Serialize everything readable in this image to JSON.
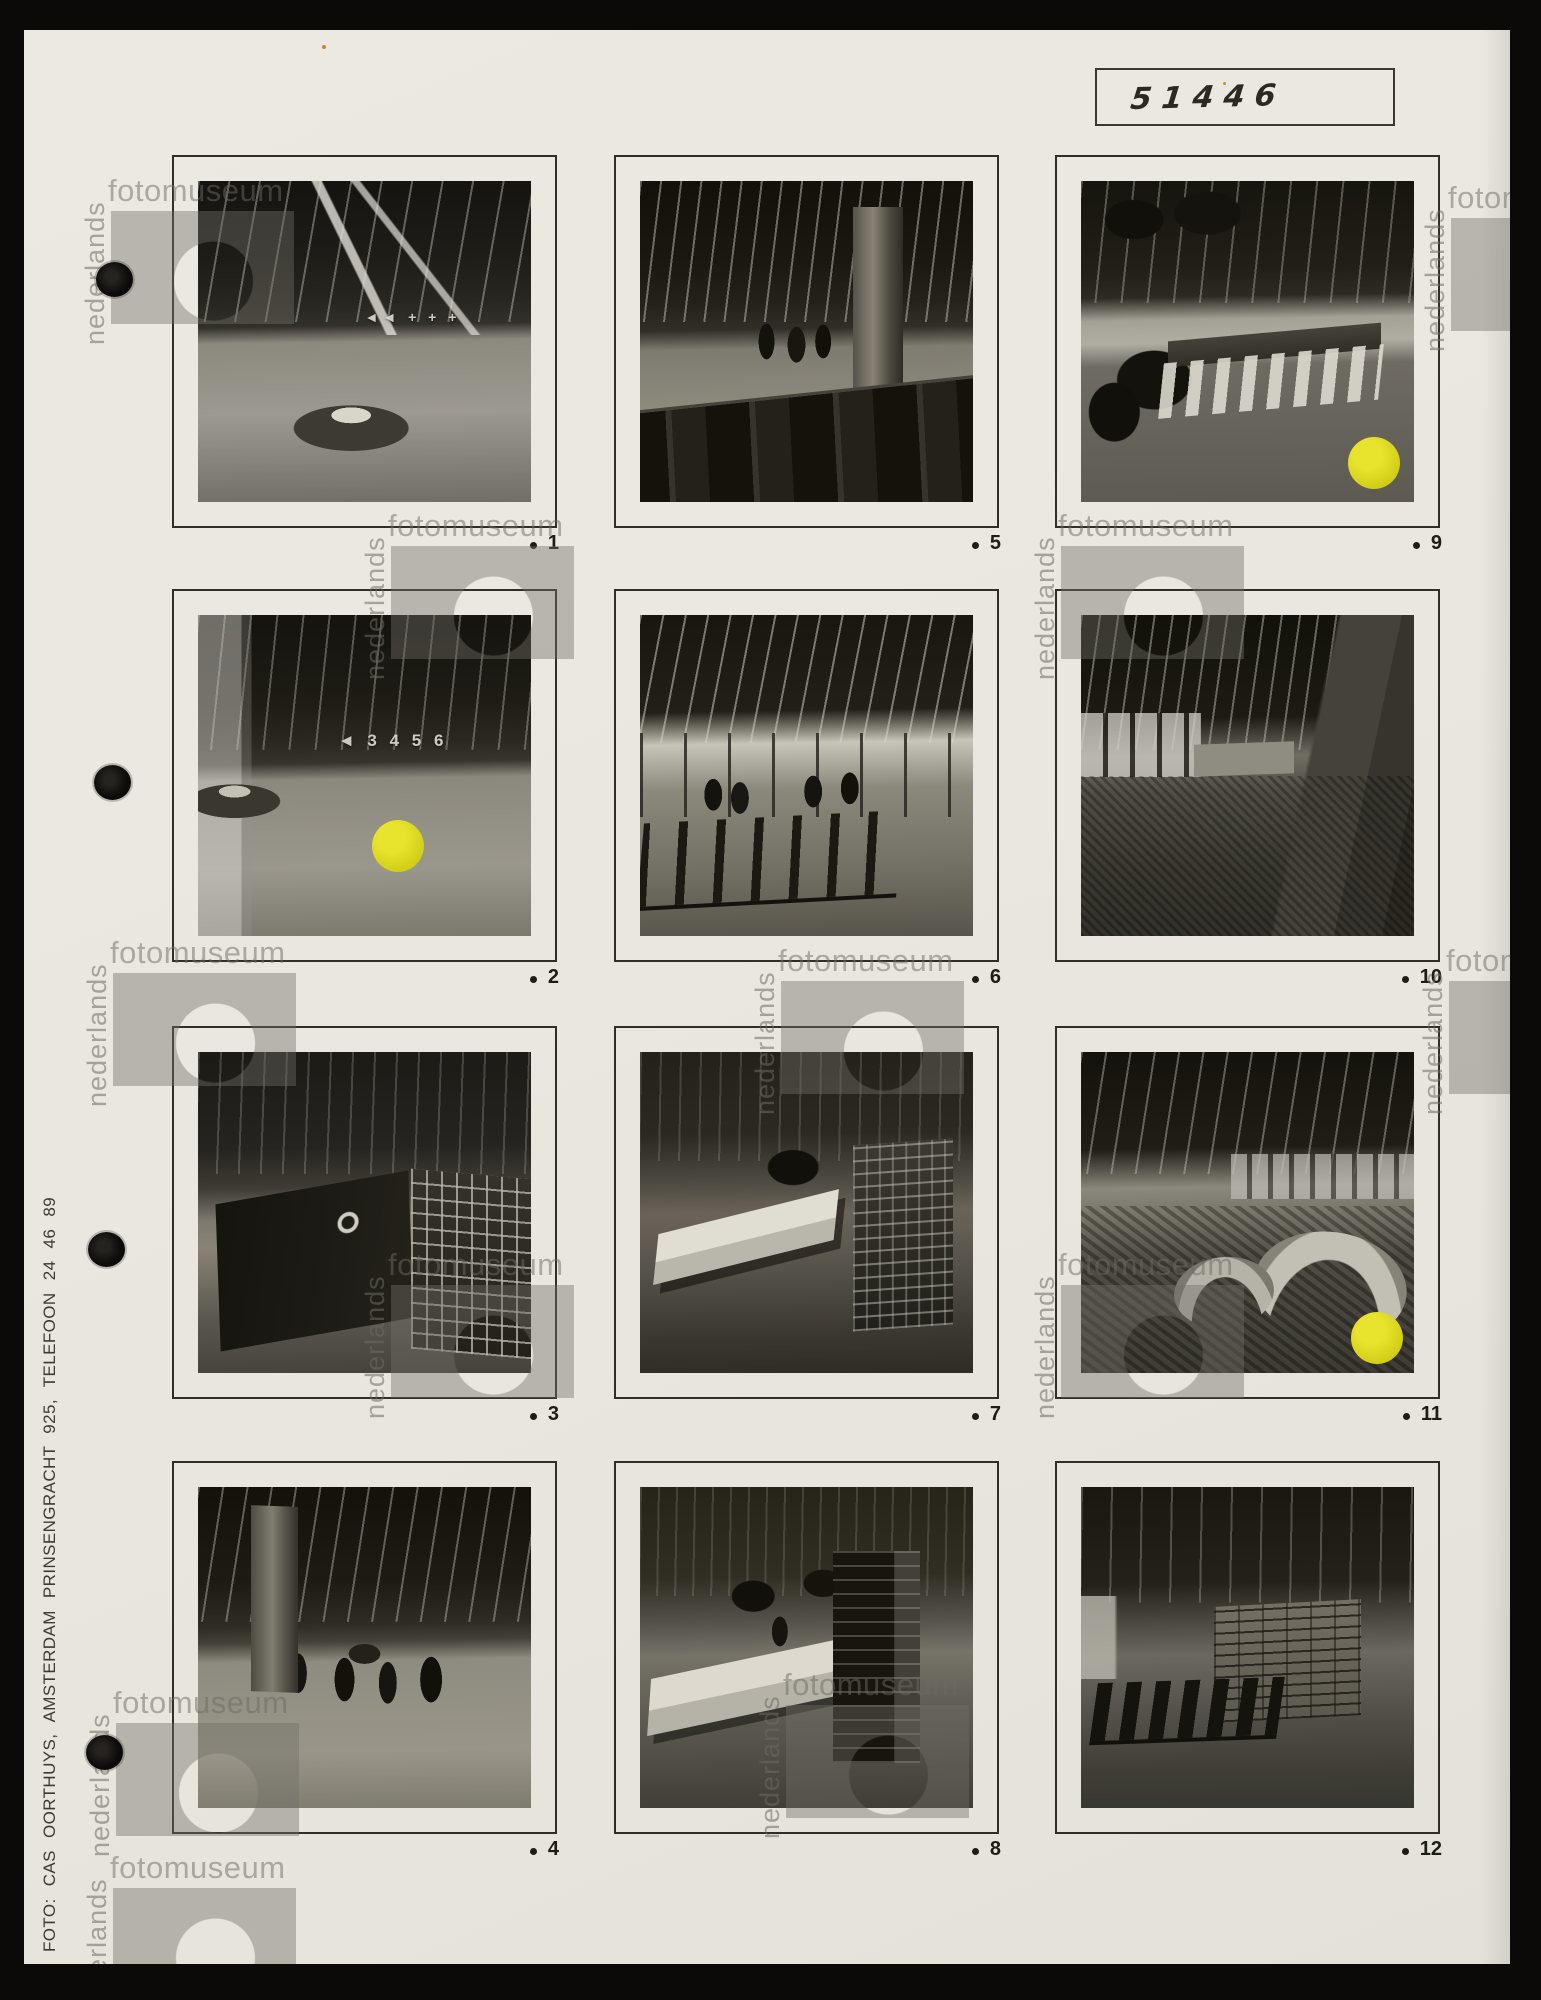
{
  "sheet": {
    "catalog_number": "51446",
    "credit": "FOTO: CAS OORTHUYS, AMSTERDAM PRINSENGRACHT 925, TELEFOON 24 46 89"
  },
  "watermark": {
    "word_vertical": "nederlands",
    "word_horizontal": "fotomuseum"
  },
  "yellow_dot_color": "#d3ce18",
  "photos": [
    {
      "number": "1",
      "scene": "s1",
      "wall_text": "◄◄  + + +",
      "yellow_dot": false,
      "description": "Entrance hall with round upholstered island seat, slatted ceiling and signage wall with arrows and crosses"
    },
    {
      "number": "2",
      "scene": "s2",
      "wall_text": "◄  3 4 5 6",
      "yellow_dot": true,
      "dot_x": "60%",
      "dot_y": "72%",
      "description": "Entrance hall with circular bench at left and numbered direction signage wall, yellow selection sticker"
    },
    {
      "number": "3",
      "scene": "s3",
      "yellow_dot": false,
      "description": "Service area with dark counter bearing a round logo and wire display racks"
    },
    {
      "number": "4",
      "scene": "s4",
      "yellow_dot": false,
      "description": "Concourse with concrete column, walking visitors and potted plants"
    },
    {
      "number": "5",
      "scene": "s5",
      "yellow_dot": false,
      "description": "Lounge with leather sofa row in foreground, visitors and concrete column"
    },
    {
      "number": "6",
      "scene": "s6",
      "yellow_dot": false,
      "description": "Waiting area with rows of chairs along a glazed facade, people seated"
    },
    {
      "number": "7",
      "scene": "s7",
      "yellow_dot": false,
      "description": "Showroom with white angular counter, plant and display shelving"
    },
    {
      "number": "8",
      "scene": "s8",
      "yellow_dot": false,
      "description": "Showroom counter with attendant, plants and display case"
    },
    {
      "number": "9",
      "scene": "s9",
      "yellow_dot": true,
      "dot_x": "88%",
      "dot_y": "88%",
      "description": "Board room with long conference table, white chairs, wall clock and foreground plant leaves, yellow selection sticker"
    },
    {
      "number": "10",
      "scene": "s10",
      "yellow_dot": false,
      "description": "Long carpeted corridor in perspective with window wall at left and doors at right"
    },
    {
      "number": "11",
      "scene": "s11",
      "yellow_dot": true,
      "dot_x": "89%",
      "dot_y": "89%",
      "description": "Lounge with curved sofas on patterned carpet and window band, yellow selection sticker"
    },
    {
      "number": "12",
      "scene": "s12",
      "yellow_dot": false,
      "description": "Waiting room with linked chairs, small table and brick partition wall"
    }
  ]
}
